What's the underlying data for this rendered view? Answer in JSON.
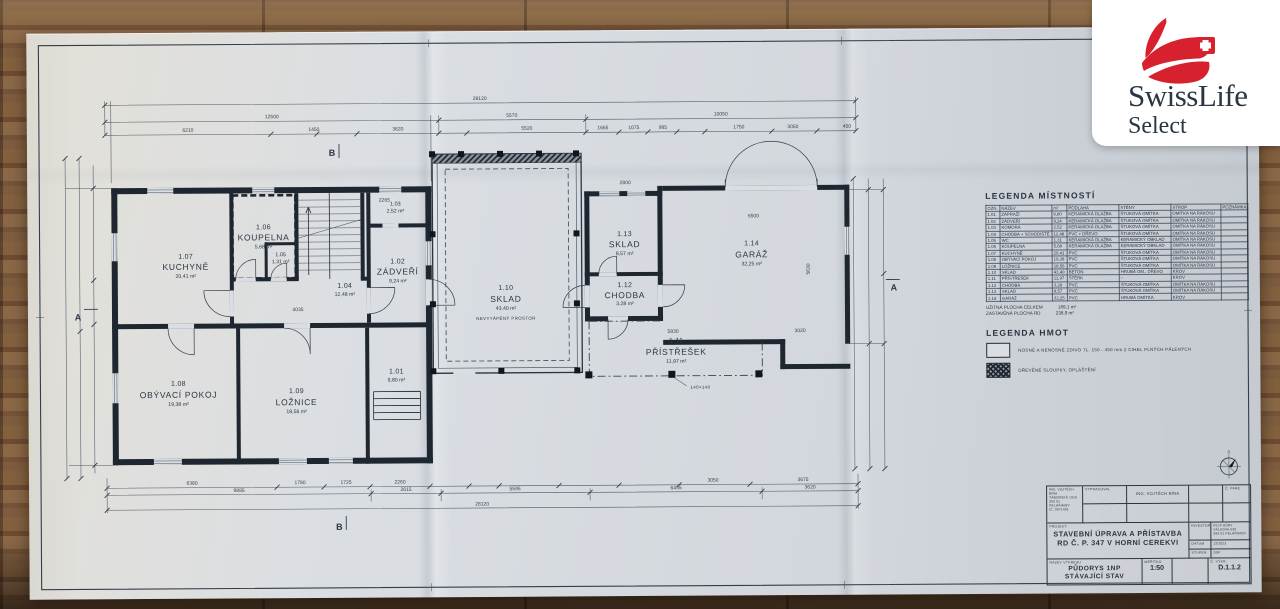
{
  "colors": {
    "accent_red": "#d7212e",
    "ink": "#2e3944",
    "paper": "#dadee3"
  },
  "logo": {
    "brand": "SwissLife",
    "sub": "Select"
  },
  "plan": {
    "rooms": {
      "r101": {
        "num": "1.01",
        "area": "9,80 m²"
      },
      "r102": {
        "num": "1.02",
        "name": "ZÁDVEŘÍ",
        "area": "9,24 m²"
      },
      "r103": {
        "num": "1.03",
        "area": "2,52 m²"
      },
      "r104": {
        "num": "1.04",
        "area": "12,48 m²"
      },
      "r105": {
        "num": "1.05",
        "area": "1,31 m²"
      },
      "r106": {
        "num": "1.06",
        "name": "KOUPELNA",
        "area": "5,68 m²"
      },
      "r107": {
        "num": "1.07",
        "name": "KUCHYNĚ",
        "area": "20,41 m²"
      },
      "r108": {
        "num": "1.08",
        "name": "OBÝVACÍ POKOJ",
        "area": "19,38 m²"
      },
      "r109": {
        "num": "1.09",
        "name": "LOŽNICE",
        "area": "18,56 m²"
      },
      "r110": {
        "num": "1.10",
        "name": "SKLAD",
        "area": "43,40 m²",
        "note": "NEVYTÁPĚNÝ PROSTOR"
      },
      "r111": {
        "num": "1.11",
        "name": "PŘÍSTŘEŠEK",
        "area": "11,97 m²"
      },
      "r112": {
        "num": "1.12",
        "name": "CHODBA",
        "area": "3,28 m²"
      },
      "r113": {
        "num": "1.13",
        "name": "SKLAD",
        "area": "8,57 m²"
      },
      "r114": {
        "num": "1.14",
        "name": "GARÁŽ",
        "area": "32,25 m²"
      }
    },
    "column_note": "140×140",
    "dims": {
      "top_total": "28120",
      "top_row": [
        "12500",
        "5570",
        "10050"
      ],
      "top_small": [
        "6210",
        "1450",
        "3620",
        "5520",
        "1665",
        "1075",
        "985",
        "1750",
        "3050",
        "450"
      ],
      "bottom_small": [
        "6380",
        "1780",
        "1725",
        "2260",
        "3050",
        "3675"
      ],
      "bottom_row": [
        "9885",
        "2615",
        "5595",
        "6435",
        "3620"
      ],
      "bottom_total": "28120",
      "interior": [
        "4035",
        "2265",
        "2800",
        "6500",
        "5830",
        "3020",
        "5630"
      ]
    },
    "sections": {
      "a": "A",
      "b": "B"
    },
    "compass_n": "S"
  },
  "legend_rooms": {
    "title": "LEGENDA MÍSTNOSTÍ",
    "headers": [
      "OZN.",
      "NÁZEV",
      "m²",
      "PODLAHA",
      "STĚNY",
      "STROP",
      "POZNÁMKA"
    ],
    "rows": [
      {
        "num": "1.01",
        "name": "ZÁPRAŽÍ",
        "area": "9,80",
        "floor": "KERAMICKÁ DLAŽBA",
        "walls": "ŠTUKOVÁ OMÍTKA",
        "ceiling": "OMÍTKA NA RÁKOSU",
        "note": ""
      },
      {
        "num": "1.02",
        "name": "ZÁDVEŘÍ",
        "area": "9,24",
        "floor": "KERAMICKÁ DLAŽBA",
        "walls": "ŠTUKOVÁ OMÍTKA",
        "ceiling": "OMÍTKA NA RÁKOSU",
        "note": ""
      },
      {
        "num": "1.03",
        "name": "KOMORA",
        "area": "2,52",
        "floor": "KERAMICKÁ DLAŽBA",
        "walls": "ŠTUKOVÁ OMÍTKA",
        "ceiling": "OMÍTKA NA RÁKOSU",
        "note": ""
      },
      {
        "num": "1.04",
        "name": "CHODBA + SCHODIŠTĚ",
        "area": "12,48",
        "floor": "PVC + DŘEVO",
        "walls": "ŠTUKOVÁ OMÍTKA",
        "ceiling": "OMÍTKA NA RÁKOSU",
        "note": ""
      },
      {
        "num": "1.05",
        "name": "WC",
        "area": "1,31",
        "floor": "KERAMICKÁ DLAŽBA",
        "walls": "KERAMICKÝ OBKLAD",
        "ceiling": "OMÍTKA NA RÁKOSU",
        "note": ""
      },
      {
        "num": "1.06",
        "name": "KOUPELNA",
        "area": "5,68",
        "floor": "KERAMICKÁ DLAŽBA",
        "walls": "KERAMICKÝ OBKLAD",
        "ceiling": "OMÍTKA NA RÁKOSU",
        "note": ""
      },
      {
        "num": "1.07",
        "name": "KUCHYNĚ",
        "area": "20,41",
        "floor": "PVC",
        "walls": "ŠTUKOVÁ OMÍTKA",
        "ceiling": "OMÍTKA NA RÁKOSU",
        "note": ""
      },
      {
        "num": "1.08",
        "name": "OBÝVACÍ POKOJ",
        "area": "19,38",
        "floor": "PVC",
        "walls": "ŠTUKOVÁ OMÍTKA",
        "ceiling": "OMÍTKA NA RÁKOSU",
        "note": ""
      },
      {
        "num": "1.09",
        "name": "LOŽNICE",
        "area": "18,56",
        "floor": "PVC",
        "walls": "ŠTUKOVÁ OMÍTKA",
        "ceiling": "OMÍTKA NA RÁKOSU",
        "note": ""
      },
      {
        "num": "1.10",
        "name": "SKLAD",
        "area": "43,40",
        "floor": "BETON",
        "walls": "HRUBÁ OM., DŘEVO",
        "ceiling": "KROV",
        "note": ""
      },
      {
        "num": "1.11",
        "name": "PŘÍSTŘEŠEK",
        "area": "11,97",
        "floor": "ŠTĚRK",
        "walls": "–",
        "ceiling": "KROV",
        "note": ""
      },
      {
        "num": "1.12",
        "name": "CHODBA",
        "area": "3,28",
        "floor": "PVC",
        "walls": "ŠTUKOVÁ OMÍTKA",
        "ceiling": "OMÍTKA NA RÁKOSU",
        "note": ""
      },
      {
        "num": "1.13",
        "name": "SKLAD",
        "area": "8,57",
        "floor": "PVC",
        "walls": "ŠTUKOVÁ OMÍTKA",
        "ceiling": "OMÍTKA NA RÁKOSU",
        "note": ""
      },
      {
        "num": "1.14",
        "name": "GARÁŽ",
        "area": "32,25",
        "floor": "PVC",
        "walls": "HRUBÁ OMÍTKA",
        "ceiling": "KROV",
        "note": ""
      }
    ],
    "totals": [
      {
        "label": "UŽITNÁ PLOCHA CELKEM",
        "value": "189,1 m²"
      },
      {
        "label": "ZASTAVĚNÁ PLOCHA RD",
        "value": "238,9 m²"
      }
    ]
  },
  "legend_materials": {
    "title": "LEGENDA HMOT",
    "items": [
      {
        "swatch": "solid-wall",
        "label": "NOSNÉ A NENOSNÉ ZDIVO TL. 150 - 450 mm Z CIHEL PLNÝCH PÁLENÝCH"
      },
      {
        "swatch": "timber-hatch",
        "label": "DŘEVĚNÉ SLOUPKY, OPLÁŠTĚNÍ"
      }
    ]
  },
  "titleblock": {
    "author_box": [
      "ING. VOJTĚCH BÍNA",
      "TÁBORSKÁ 1915",
      "393 01 PELHŘIMOV",
      "IČ: 0871491"
    ],
    "vypracoval_label": "VYPRACOVAL",
    "vypracoval_value": "ING. VOJTĚCH BÍNA",
    "pare_label": "Č. PARÉ",
    "projekt_label": "PROJEKT:",
    "projekt_line1": "STAVEBNÍ ÚPRAVA A PŘÍSTAVBA",
    "projekt_line2": "RD Č. P. 347 V HORNÍ CEREKVI",
    "investor_label": "INVESTOR",
    "investor_lines": [
      "FILIP HŮRY",
      "VÁLKOVA 630",
      "393 01 PELHŘIMOV"
    ],
    "datum_label": "DATUM",
    "datum_value": "12/2023",
    "stupen_label": "STUPEŇ",
    "stupen_value": "DSP",
    "nazev_label": "NÁZEV VÝKRESU",
    "nazev_line1": "PŮDORYS 1NP",
    "nazev_line2": "STÁVAJÍCÍ STAV",
    "meritko_label": "MĚŘÍTKO",
    "meritko_value": "1:50",
    "cislo_label": "Č. VÝKR.",
    "cislo_value": "D.1.1.2"
  }
}
